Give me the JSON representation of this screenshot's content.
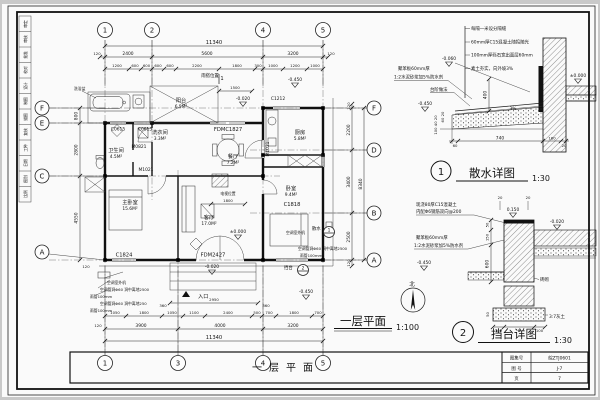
{
  "sheet": {
    "page_bg": "#c9c9c9",
    "paper": "#fafafa",
    "ink": "#1b1b1b"
  },
  "signature_strip": [
    "审定",
    "审核",
    "批准",
    "校对",
    "设计",
    "制图",
    "描图",
    "复核",
    "工种",
    "日期",
    "图别",
    "比例"
  ],
  "plan": {
    "title": "一层平面",
    "scale": "1:100",
    "north": "北",
    "section_flag": "1",
    "grid_top": [
      "1",
      "2",
      "4",
      "5"
    ],
    "grid_bottom": [
      "1",
      "3",
      "4",
      "5"
    ],
    "grid_left": [
      "F",
      "E",
      "C",
      "A"
    ],
    "grid_right": [
      "F",
      "D",
      "B",
      "A"
    ],
    "dims": {
      "top_total": "11340",
      "top_row2": [
        "120",
        "2400",
        "5600",
        "3200",
        "120"
      ],
      "top_row3": [
        "1200",
        "600",
        "600",
        "600",
        "600",
        "2200",
        "1800",
        "300",
        "1000",
        "1200",
        "1000"
      ],
      "bottom_row1": [
        "1050",
        "1800",
        "1050",
        "1100",
        "2400",
        "500",
        "700",
        "1800",
        "700"
      ],
      "bottom_row2": [
        "120",
        "3900",
        "4000",
        "3200"
      ],
      "bottom_total": "11340",
      "left": [
        "800",
        "2800",
        "4550",
        "120"
      ],
      "right": [
        "120",
        "2200",
        "3400",
        "2500",
        "120"
      ],
      "right_total": "8340",
      "canopy": "1500",
      "tv": "1800",
      "entry_w": "2950",
      "entry_s": "360"
    },
    "rooms": [
      {
        "n": "阳台",
        "a": "6.5M²"
      },
      {
        "n": "卫生间",
        "a": "4.5M²"
      },
      {
        "n": "洗衣间",
        "a": "3.3M²"
      },
      {
        "n": "餐厅",
        "a": "7.2M²"
      },
      {
        "n": "厨房",
        "a": "5.8M²"
      },
      {
        "n": "主卧室",
        "a": "15.6M²"
      },
      {
        "n": "客厅",
        "a": "17.0M²"
      },
      {
        "n": "卧室",
        "a": "9.4M²"
      }
    ],
    "openings": {
      "c0615a": "C0615",
      "c0615b": "C0615",
      "fdmc1827": "FDMC1827",
      "c1212": "C1212",
      "m0821": "M0821",
      "m1021a": "M1021",
      "m1021b": "M1021",
      "c1824": "C1824",
      "fdm2427": "FDM2427",
      "c1818": "C1818"
    },
    "levels": {
      "zero": "±0.000",
      "n020": "-0.020",
      "n020b": "-0.020",
      "n450a": "-0.450",
      "n450b": "-0.450"
    },
    "notes": {
      "canopy": "雨搭位置",
      "tv": "电视位置",
      "entrance": "入口",
      "bathtub": "洗浴盆",
      "apron": "散水",
      "apron_ref": "1",
      "platform": "挡台",
      "platform_ref": "2",
      "ac_unit_l": "空调室外机",
      "ac_hole_l1": "空调管洞Φ60 洞中离地2500",
      "rain_l1": "雨管100mm",
      "ac_hole_l2": "空调管洞Φ60 洞中离地250",
      "rain_l2": "雨管100mm",
      "ac_unit_r": "空调室外机",
      "ac_hole_r": "空调管洞Φ60 洞中离地2500",
      "rain_r": "雨管100mm"
    }
  },
  "detail1": {
    "ref": "1",
    "title": "散水详图",
    "scale": "1:30",
    "notes": [
      "每隔一米设分隔缝",
      "60mm厚C15混凝土随捣随光",
      "100mm厚砾石宽出面层60mm",
      "素土夯实，向外坡3%"
    ],
    "ins1": "聚苯板60mm厚",
    "ins2": "1:2水泥砂浆加5%防水剂",
    "step": "台阶做法",
    "lv_top": "-0.060",
    "lv_mid": "-0.450",
    "lv_zero": "±0.000",
    "d400": "400",
    "slope": "3%",
    "d60": "60",
    "d740": "740",
    "d180": "180",
    "d20": "20",
    "dv1": "60 20",
    "dv2": "100 40 20"
  },
  "detail2": {
    "ref": "2",
    "title": "挡台详图",
    "scale": "1:30",
    "conc1": "现浇80厚C15混凝土",
    "conc2": "内配Φ6钢筋双向@200",
    "ins1": "聚苯板60mm厚",
    "ins2": "1:2水泥砂浆加5%防水剂",
    "brick": "砖砌",
    "lime": "3:7灰土",
    "lv_top": "0.150",
    "lv_right": "-0.020",
    "lv_left": "-0.450",
    "d20a": "20",
    "d20b": "20",
    "d50a": "50",
    "d150": "150",
    "d600": "600",
    "d50b": "50",
    "d100a": "100",
    "dB": "B",
    "d100b": "100"
  },
  "title_block": {
    "drawing_title": "一层平面",
    "rows": [
      {
        "label": "图集号",
        "value": "皖ZTJ0601"
      },
      {
        "label": "图 号",
        "value": "J-7"
      },
      {
        "label": "页",
        "value": "7"
      }
    ]
  }
}
